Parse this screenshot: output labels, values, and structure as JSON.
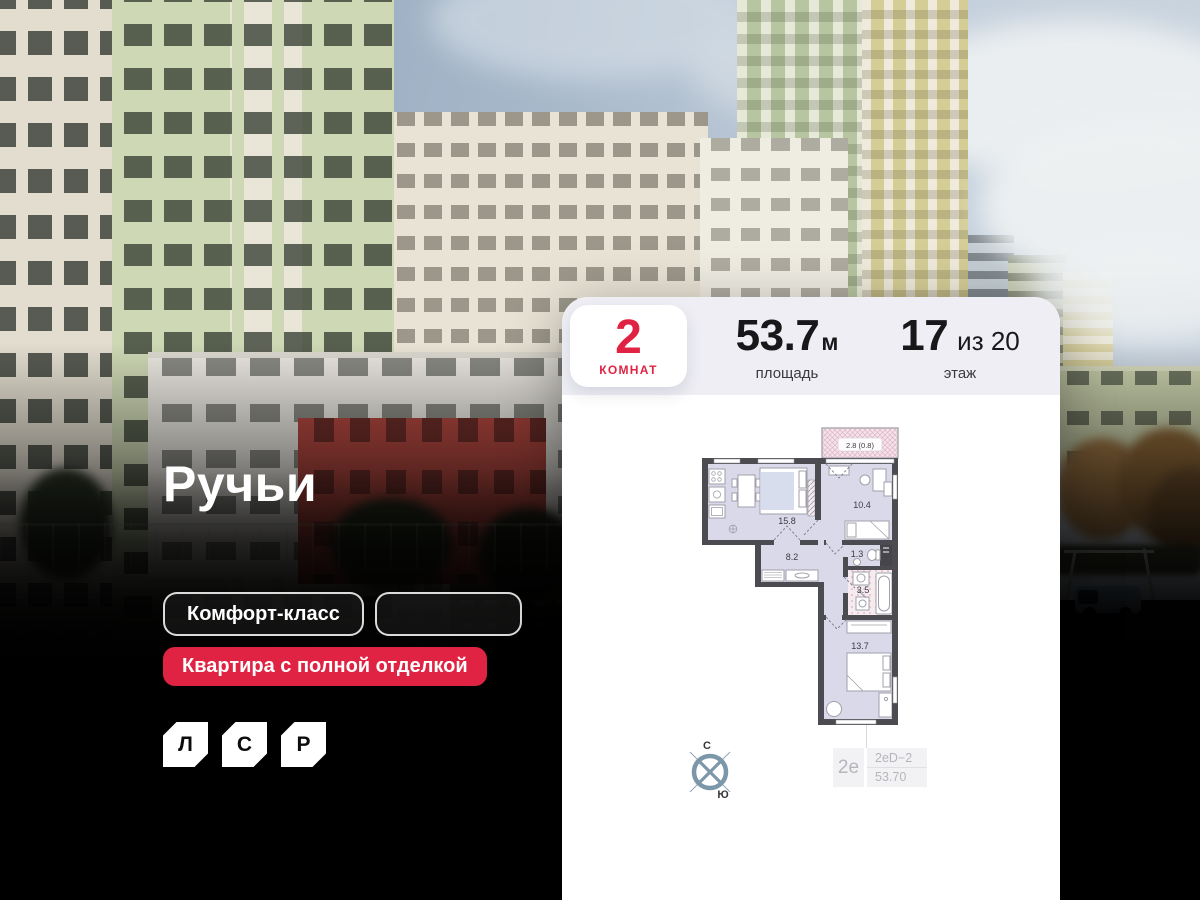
{
  "overlay": {
    "title": "Ручьи",
    "badge_class": "Комфорт-класс",
    "badge_empty": "",
    "badge_finish": "Квартира с полной отделкой",
    "logo_letters": {
      "l": "Л",
      "s": "С",
      "r": "Р"
    }
  },
  "card": {
    "rooms_value": "2",
    "rooms_label": "комнат",
    "area_value": "53.7",
    "area_unit": "м",
    "area_label": "площадь",
    "floor_value": "17",
    "floor_of": "из 20",
    "floor_label": "этаж",
    "plan": {
      "balcony": "2.8 (0.8)",
      "kitchen_living": "15.8",
      "bedroom": "10.4",
      "hallway": "8.2",
      "wc": "1.3",
      "bathroom": "3.5",
      "bedroom2": "13.7"
    },
    "compass": {
      "north": "С",
      "south": "Ю"
    },
    "type": {
      "short": "2е",
      "code": "2еD−2",
      "area": "53.70"
    }
  },
  "colors": {
    "accent_red": "#e02343",
    "card_header": "#eeeef4",
    "plan_wall": "#4b4b51",
    "plan_room": "#d9d9ea",
    "plan_balcony": "#f6e3eb"
  }
}
